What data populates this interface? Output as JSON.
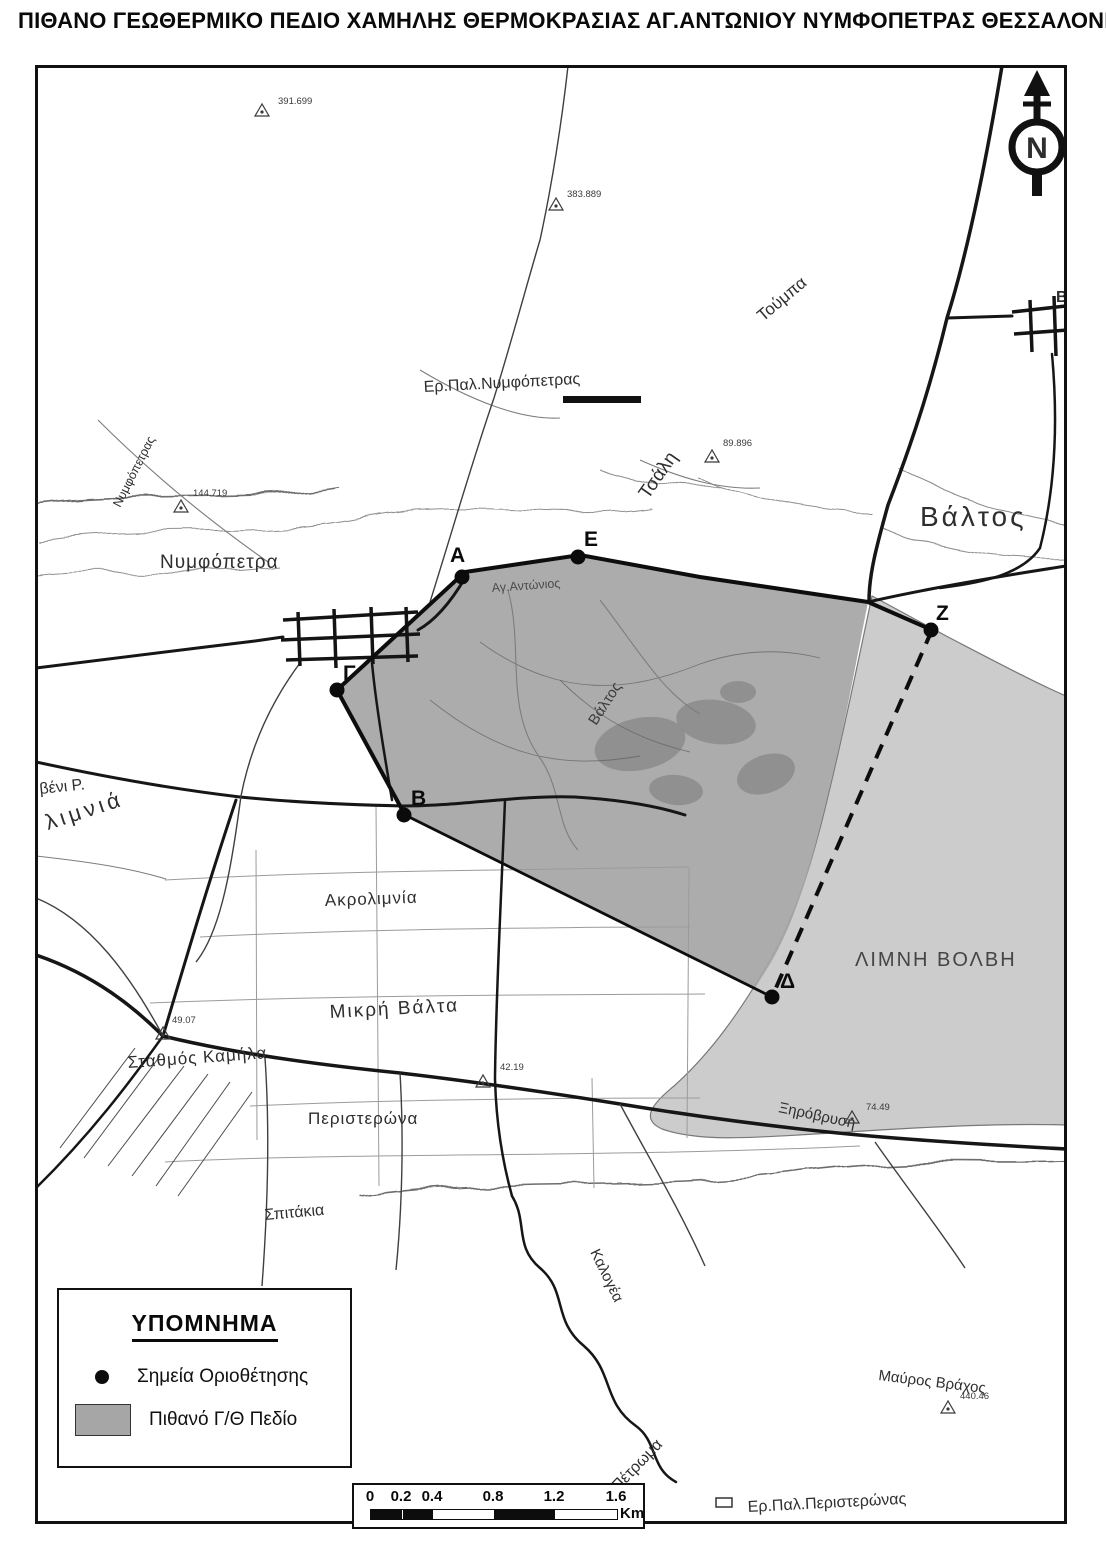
{
  "title": "ΠΙΘΑΝΟ ΓΕΩΘΕΡΜΙΚΟ ΠΕΔΙΟ ΧΑΜΗΛΗΣ ΘΕΡΜΟΚΡΑΣΙΑΣ ΑΓ.ΑΝΤΩΝΙΟΥ ΝΥΜΦΟΠΕΤΡΑΣ ΘΕΣΣΑΛΟΝΙΚΗΣ",
  "legend": {
    "title": "ΥΠΟΜΝΗΜΑ",
    "items": [
      {
        "symbol": "dot",
        "label": "Σημεία Οριοθέτησης"
      },
      {
        "symbol": "area",
        "label": "Πιθανό Γ/Θ Πεδίο"
      }
    ]
  },
  "scalebar": {
    "ticks": [
      "0",
      "0.2",
      "0.4",
      "0.8",
      "1.2",
      "1.6"
    ],
    "unit": "Km"
  },
  "north": {
    "label": "N"
  },
  "map": {
    "labels": [
      {
        "t": "Ερ.Παλ.Νυμφόπετρας",
        "x": 424,
        "y": 392,
        "s": 16,
        "r": -3
      },
      {
        "t": "Τούμπα",
        "x": 763,
        "y": 322,
        "s": 17,
        "r": -40
      },
      {
        "t": "Τσάλη",
        "x": 648,
        "y": 500,
        "s": 19,
        "r": -55
      },
      {
        "t": "Βάλτος",
        "x": 920,
        "y": 526,
        "s": 28,
        "ls": 3
      },
      {
        "t": "Βα",
        "x": 1056,
        "y": 302,
        "s": 16,
        "b": 1
      },
      {
        "t": "Νυμφόπετρα",
        "x": 160,
        "y": 568,
        "s": 19,
        "ls": 1
      },
      {
        "t": "Νυμφόπετρας",
        "x": 120,
        "y": 508,
        "s": 12.5,
        "r": -63
      },
      {
        "t": "Αγ.Αντώνιος",
        "x": 492,
        "y": 592,
        "s": 12.5,
        "r": -4,
        "c": "#4c4c4c"
      },
      {
        "t": "Βάλτος",
        "x": 596,
        "y": 726,
        "s": 15,
        "r": -57,
        "c": "#3d3d3d"
      },
      {
        "t": "βένι Ρ.",
        "x": 40,
        "y": 794,
        "s": 16,
        "r": -6
      },
      {
        "t": "λιμνιά",
        "x": 48,
        "y": 830,
        "s": 22,
        "r": -18,
        "ls": 4
      },
      {
        "t": "Ακρολιμνία",
        "x": 325,
        "y": 906,
        "s": 17,
        "ls": 1,
        "r": -2
      },
      {
        "t": "Μικρή Βάλτα",
        "x": 330,
        "y": 1018,
        "s": 19,
        "ls": 2,
        "r": -3
      },
      {
        "t": "Σταθμός Καμήλα",
        "x": 128,
        "y": 1068,
        "s": 17,
        "r": -4,
        "ls": 1
      },
      {
        "t": "Περιστερώνα",
        "x": 308,
        "y": 1124,
        "s": 17,
        "ls": 1
      },
      {
        "t": "Σπιτάκια",
        "x": 265,
        "y": 1220,
        "s": 16,
        "r": -5
      },
      {
        "t": "Ξηρόβρυση",
        "x": 778,
        "y": 1112,
        "s": 15,
        "r": 12
      },
      {
        "t": "ΛΙΜΝΗ ΒΟΛΒΗ",
        "x": 855,
        "y": 966,
        "s": 20,
        "ls": 2,
        "c": "#454545"
      },
      {
        "t": "Μαύρος Βράχος",
        "x": 878,
        "y": 1380,
        "s": 15,
        "r": 7
      },
      {
        "t": "Καλογέα",
        "x": 590,
        "y": 1252,
        "s": 15,
        "r": 64
      },
      {
        "t": "Πέτρωμα",
        "x": 618,
        "y": 1492,
        "s": 16,
        "r": -46
      },
      {
        "t": "Ερ.Παλ.Περιστερώνας",
        "x": 748,
        "y": 1512,
        "s": 16,
        "r": -3
      },
      {
        "t": "N",
        "x": 1037,
        "y": 158,
        "s": 30,
        "b": 1,
        "a": "middle"
      }
    ],
    "vertices": [
      {
        "n": "Α",
        "x": 462,
        "y": 577,
        "lx": 450,
        "ly": 562
      },
      {
        "n": "Β",
        "x": 404,
        "y": 815,
        "lx": 411,
        "ly": 805
      },
      {
        "n": "Γ",
        "x": 337,
        "y": 690,
        "lx": 343,
        "ly": 680
      },
      {
        "n": "Δ",
        "x": 772,
        "y": 997,
        "lx": 780,
        "ly": 988
      },
      {
        "n": "Ε",
        "x": 578,
        "y": 557,
        "lx": 584,
        "ly": 546
      },
      {
        "n": "Ζ",
        "x": 931,
        "y": 630,
        "lx": 936,
        "ly": 620
      }
    ],
    "elevations": [
      {
        "v": "391.699",
        "x": 278,
        "y": 104,
        "tx": 262,
        "ty": 112
      },
      {
        "v": "383.889",
        "x": 567,
        "y": 197,
        "tx": 556,
        "ty": 206
      },
      {
        "v": "89.896",
        "x": 723,
        "y": 446,
        "tx": 712,
        "ty": 458
      },
      {
        "v": "144.719",
        "x": 193,
        "y": 496,
        "tx": 181,
        "ty": 508
      },
      {
        "v": "49.07",
        "x": 172,
        "y": 1023,
        "tx": 163,
        "ty": 1035
      },
      {
        "v": "42.19",
        "x": 500,
        "y": 1070,
        "tx": 483,
        "ty": 1083
      },
      {
        "v": "74.49",
        "x": 866,
        "y": 1110,
        "tx": 852,
        "ty": 1119
      },
      {
        "v": "440.46",
        "x": 960,
        "y": 1399,
        "tx": 948,
        "ty": 1409
      }
    ]
  },
  "colors": {
    "field": "#a6a6a6",
    "lake": "#cccccc",
    "swamp": "#8e8e8e",
    "contour": "#8f8f8f",
    "contour_index": "#6d6d6d",
    "road": "#161616",
    "label": "#2e2e2e"
  }
}
